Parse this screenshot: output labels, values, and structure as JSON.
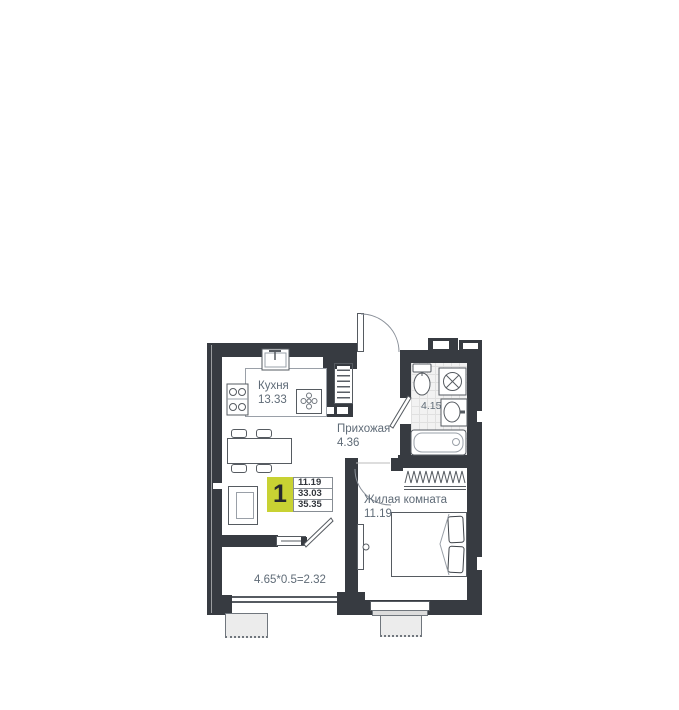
{
  "rooms": {
    "kitchen": {
      "name": "Кухня",
      "area": "13.33"
    },
    "hallway": {
      "name": "Прихожая",
      "area": "4.36"
    },
    "bathroom": {
      "area": "4.15"
    },
    "living_room": {
      "name": "Жилая комната",
      "area": "11.19"
    },
    "balcony": {
      "area_formula": "4.65*0.5=2.32"
    }
  },
  "badge": {
    "room_count": "1",
    "living_area": "11.19",
    "area_without_balcony": "33.03",
    "total_area": "35.35"
  },
  "colors": {
    "wall": "#373b41",
    "badge_yellow": "#c8d233",
    "label_text": "#5f6b77"
  }
}
